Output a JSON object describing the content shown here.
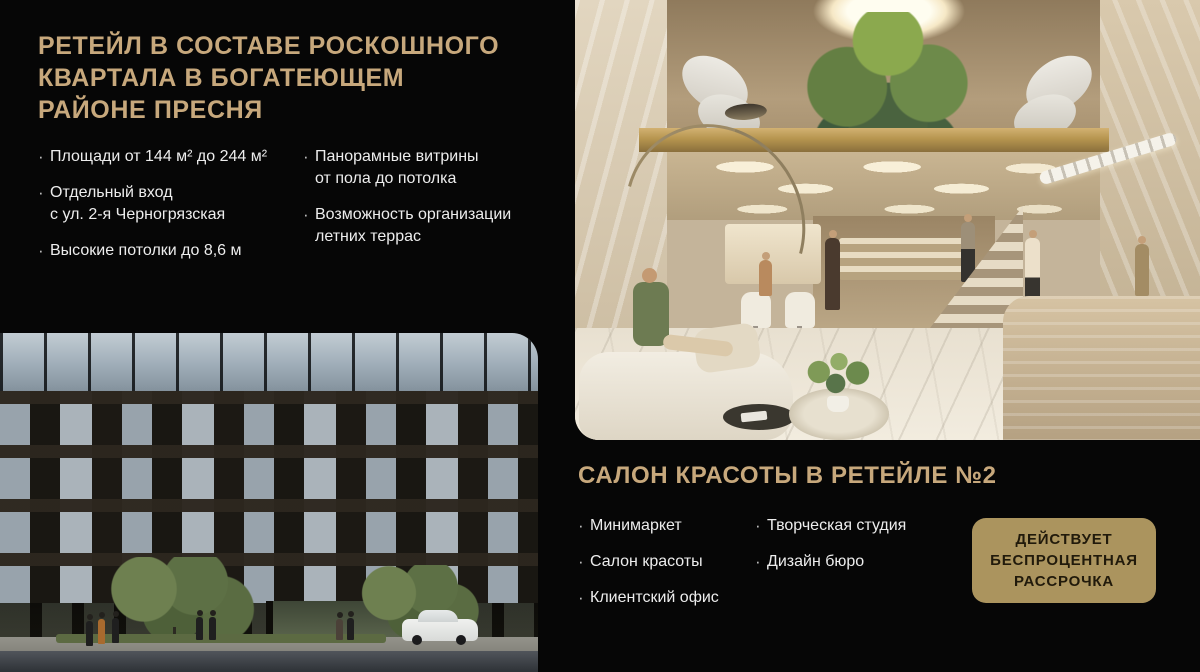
{
  "meta": {
    "bullet_char": "·"
  },
  "colors": {
    "background": "#060606",
    "gold_accent": "#c7a87c",
    "body_text": "#ededed",
    "badge_bg": "#ab945e",
    "badge_text": "#211a0b"
  },
  "retail": {
    "title": "РЕТЕЙЛ В СОСТАВЕ РОСКОШНОГО\nКВАРТАЛА В БОГАТЕЮЩЕМ\nРАЙОНЕ ПРЕСНЯ",
    "features_col1": [
      "Площади от 144 м² до 244 м²",
      "Отдельный вход\nс ул. 2-я Черногрязская",
      "Высокие потолки до 8,6 м"
    ],
    "features_col2": [
      "Панорамные витрины\nот пола до потолка",
      "Возможность организации\nлетних террас"
    ]
  },
  "salon": {
    "title": "САЛОН КРАСОТЫ В РЕТЕЙЛЕ №2",
    "tenants_col1": [
      "Минимаркет",
      "Салон красоты",
      "Клиентский офис"
    ],
    "tenants_col2": [
      "Творческая студия",
      "Дизайн бюро"
    ],
    "badge": "ДЕЙСТВУЕТ\nБЕСПРОЦЕНТНАЯ\nРАССРОЧКА"
  }
}
